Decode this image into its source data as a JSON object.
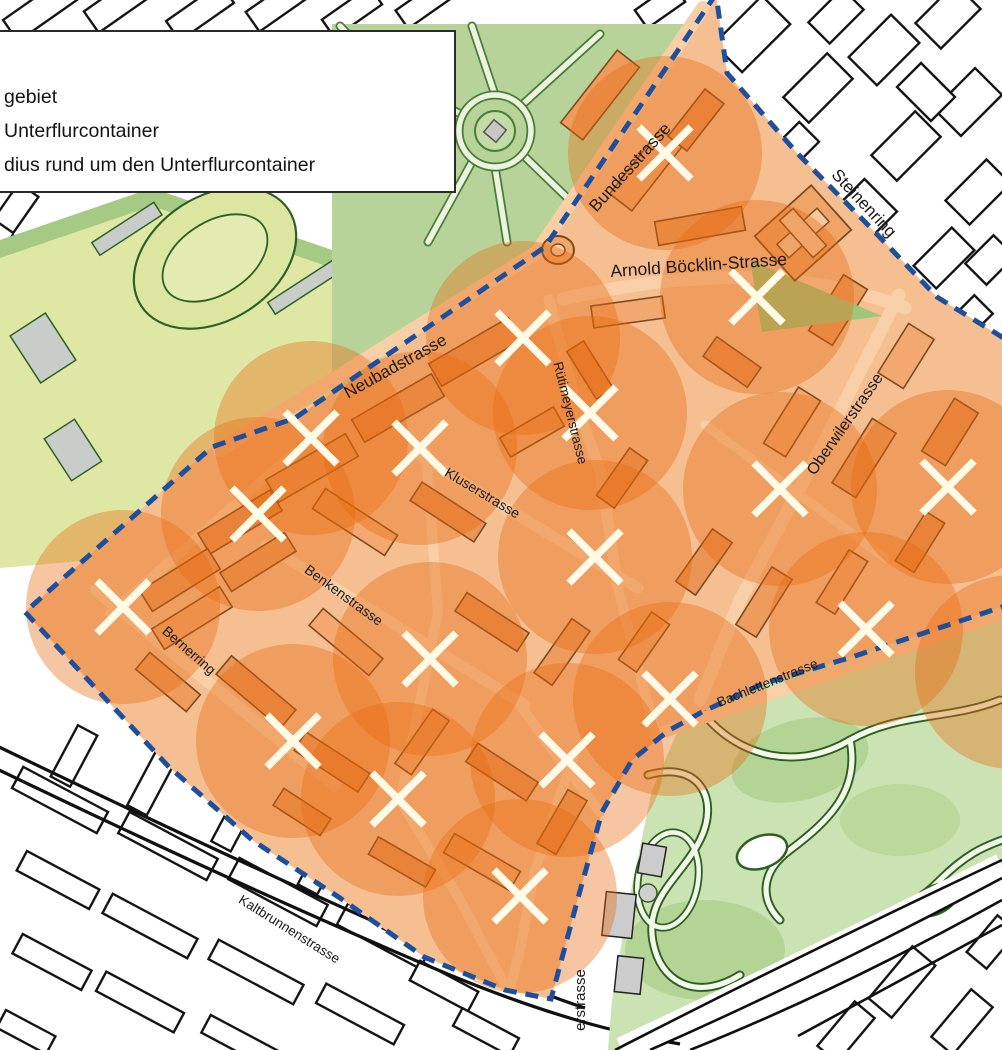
{
  "legend": {
    "items": [
      {
        "label": "gebiet"
      },
      {
        "label": "Unterflurcontainer"
      },
      {
        "label": "dius rund um den Unterflurcontainer"
      }
    ]
  },
  "map": {
    "street_labels": [
      {
        "name": "Bundesstrasse",
        "x": 634,
        "y": 171,
        "rotation": -48,
        "size": 17
      },
      {
        "name": "Steinenring",
        "x": 860,
        "y": 207,
        "rotation": 47,
        "size": 17
      },
      {
        "name": "Arnold Böcklin-Strasse",
        "x": 699,
        "y": 271,
        "rotation": -4,
        "size": 17.5
      },
      {
        "name": "Neubadstrasse",
        "x": 398,
        "y": 371,
        "rotation": -29,
        "size": 17
      },
      {
        "name": "Rütimeyerstrasse",
        "x": 566,
        "y": 414,
        "rotation": 76,
        "size": 13.5
      },
      {
        "name": "Kluserstrasse",
        "x": 480,
        "y": 497,
        "rotation": 31,
        "size": 14
      },
      {
        "name": "Oberwilerstrasse",
        "x": 849,
        "y": 427,
        "rotation": -55,
        "size": 16
      },
      {
        "name": "Benkenstrasse",
        "x": 341,
        "y": 599,
        "rotation": 36,
        "size": 14
      },
      {
        "name": "Bernerring",
        "x": 186,
        "y": 654,
        "rotation": 41,
        "size": 14
      },
      {
        "name": "Bachlettenstrasse",
        "x": 769,
        "y": 687,
        "rotation": -22,
        "size": 13.5
      },
      {
        "name": "Kaltbrunnenstrasse",
        "x": 287,
        "y": 933,
        "rotation": 32,
        "size": 13.5
      },
      {
        "name": "erstrasse",
        "x": 585,
        "y": 1000,
        "rotation": -90,
        "size": 15
      }
    ],
    "containers": {
      "count": 18,
      "radius_px": 97,
      "positions": [
        [
          665,
          153
        ],
        [
          757,
          297
        ],
        [
          523,
          338
        ],
        [
          590,
          413
        ],
        [
          311,
          438
        ],
        [
          420,
          448
        ],
        [
          948,
          487
        ],
        [
          780,
          489
        ],
        [
          258,
          514
        ],
        [
          595,
          557
        ],
        [
          123,
          607
        ],
        [
          866,
          629
        ],
        [
          430,
          659
        ],
        [
          670,
          699
        ],
        [
          293,
          741
        ],
        [
          567,
          760
        ],
        [
          398,
          799
        ],
        [
          520,
          896
        ]
      ],
      "radius_only_centers": [
        [
          1012,
          672
        ]
      ]
    },
    "colors": {
      "boundary": "#1d4f9e",
      "radius_fill": "#e8680e",
      "marker": "#fffbe8",
      "area_base": "#f5bf92",
      "area_street": "#f8cfa6",
      "area_building": "#ee9b5e",
      "area_building_alt": "#f2a870",
      "building_outline": "#7d4a1f",
      "outside_building": "#ffffff",
      "outline_dark": "#1a1a1a",
      "park_green": "#b7d39a",
      "park_strip": "#a4ca84",
      "field_green": "#dfe7a5",
      "zoo_green": "#cbe2b2",
      "zoo_patch": "#b3d494",
      "zoo_path_casing": "#2f5e22",
      "gray": "#c9cdc9"
    }
  }
}
